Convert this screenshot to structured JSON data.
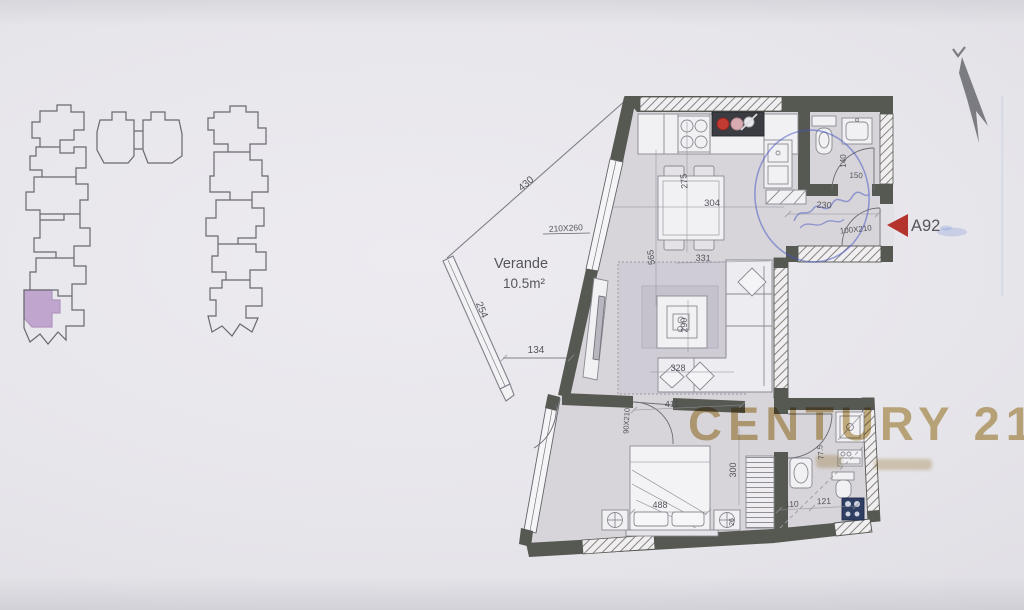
{
  "site_key": {
    "highlighted_unit_color": "#b18cc2"
  },
  "north_arrow": {
    "color": "#686a70"
  },
  "veranda": {
    "name": "Verande",
    "area": "10.5m²",
    "dim_top": "430",
    "dim_side": "254",
    "dim_bottom": "134"
  },
  "living_kitchen": {
    "window": "210X260",
    "dining_width": "304",
    "dining_depth": "275",
    "length": "565",
    "width_top": "331",
    "table_width": "290",
    "width_bottom": "328"
  },
  "hall": {
    "width": "230",
    "entrance_door": "100X210",
    "unit_code": "A92",
    "marker_color": "#b5332d"
  },
  "bath_main": {
    "width": "140",
    "length": "150"
  },
  "bedroom": {
    "width_top": "411",
    "door": "90X210",
    "bed_width": "488",
    "depth": "300",
    "nightstand_depth": "26"
  },
  "bath_ensuite": {
    "depth": "77.5",
    "width_left": "110",
    "width_right": "121"
  },
  "watermark": {
    "brand": "CENTURY 21",
    "color": "#c1a669"
  },
  "colors": {
    "wall": "#565852",
    "floor": "#d8d5da",
    "pen_blue": "#4553c2"
  }
}
